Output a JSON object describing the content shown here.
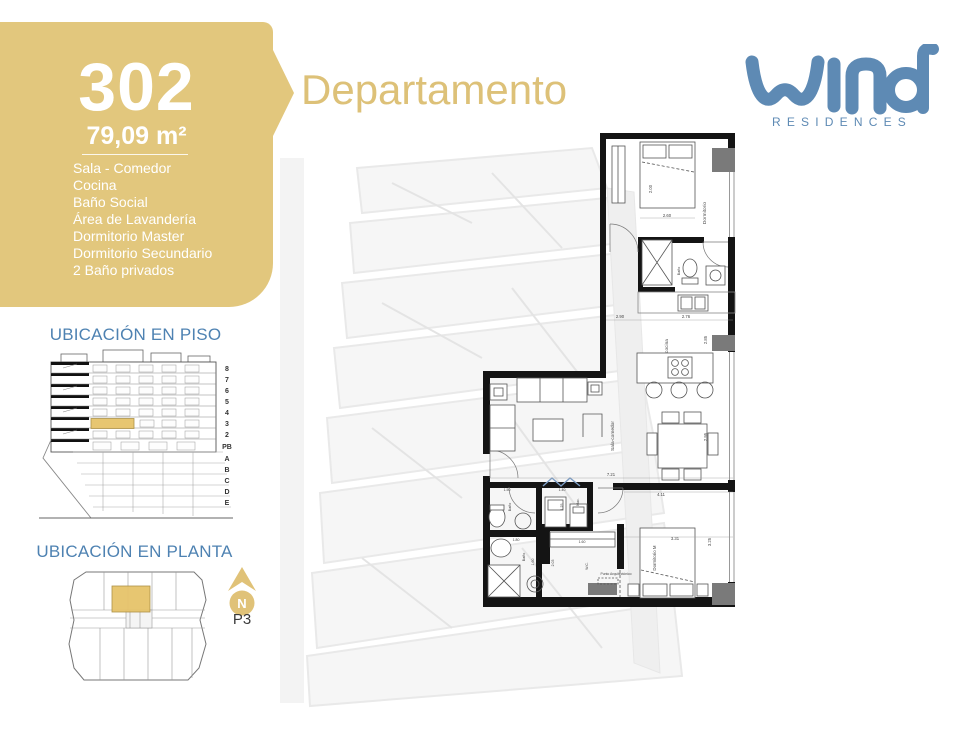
{
  "colors": {
    "gold": "#e2c77d",
    "heading_blue": "#4e82b2",
    "logo_blue": "#5e8ab4",
    "highlight": "#e6c36a"
  },
  "unit": {
    "number": "302",
    "area": "79,09 m²",
    "amenities": [
      "Sala - Comedor",
      "Cocina",
      "Baño Social",
      "Área de Lavandería",
      "Dormitorio Master",
      "Dormitorio Secundario",
      "2 Baño privados"
    ]
  },
  "header": {
    "title": "Departamento"
  },
  "logo": {
    "brand": "wind",
    "sub": "RESIDENCES"
  },
  "piso": {
    "heading": "UBICACIÓN EN PISO",
    "floors": [
      "8",
      "7",
      "6",
      "5",
      "4",
      "3",
      "2",
      "PB",
      "A",
      "B",
      "C",
      "D",
      "E"
    ]
  },
  "planta": {
    "heading": "UBICACIÓN EN PLANTA",
    "compass": "N",
    "level": "P3"
  },
  "plan": {
    "labels": {
      "dormitorio": "Dormitorio",
      "bano_suite": "Baño",
      "cocina": "cocina",
      "sala": "Sala-comedor",
      "bano_hall": "Baño",
      "laundry": "Mac.",
      "bano_2": "Baño",
      "wc": "W.C.",
      "dormitorio_m": "Dormitorio M",
      "punto": "Punto Arquitectónico"
    },
    "dims": {
      "bed": "2.00",
      "bedroom_w": "2.60",
      "kitchen_l": "2.90",
      "kitchen_r": "2.76",
      "kitchen_h": "2.85",
      "living_w": "7.21",
      "master_hall": "4.11",
      "dining_h": "2.95",
      "master_w": "3.31",
      "master_h": "3.25",
      "laundry_w": "1.40",
      "laundry_h": "1.25",
      "bath1_w": "1.50",
      "bath2_w": "1.80",
      "closet_w": "1.60",
      "bath2_h": "1.60",
      "hall_h": "2.03"
    }
  }
}
